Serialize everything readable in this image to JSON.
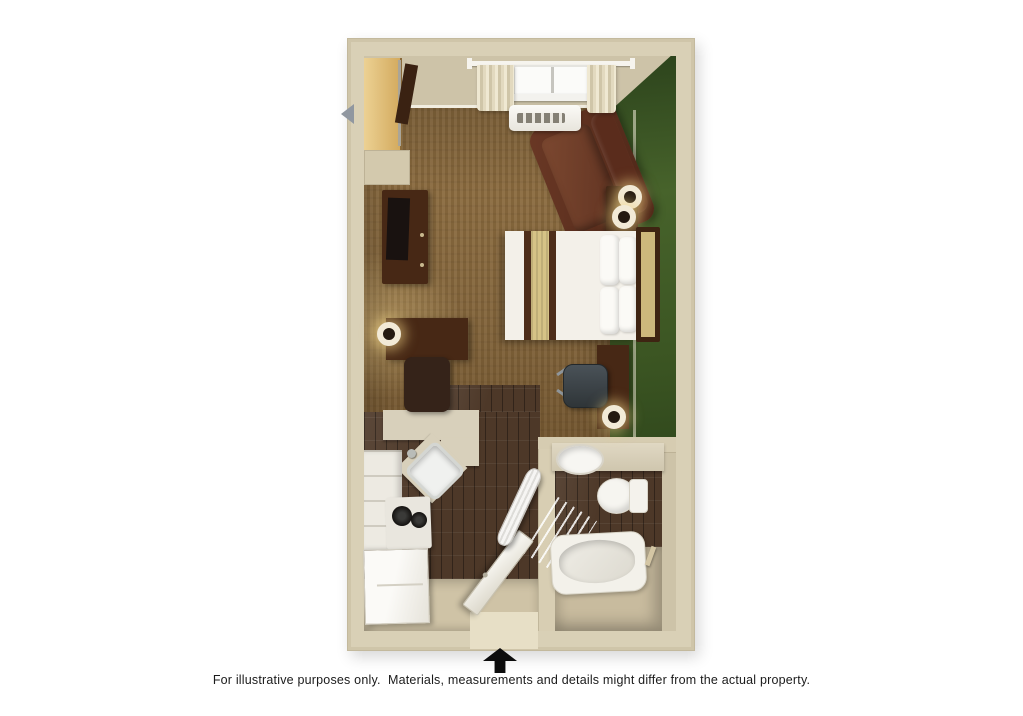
{
  "scene": {
    "type": "3d-floorplan-studio-suite",
    "caption": {
      "text": "For illustrative purposes only.  Materials, measurements and details might differ from the actual property."
    },
    "north_arrow": "entrance-direction-arrow"
  },
  "rooms": [
    {
      "name": "bedroom-living-area",
      "floor": "brown-carpet"
    },
    {
      "name": "kitchen",
      "floor": "dark-wood-plank"
    },
    {
      "name": "entry-hallway",
      "floor": "dark-wood-plank-and-tile"
    },
    {
      "name": "bathroom",
      "floor": "dark-wood-plank-and-tile"
    }
  ],
  "fixtures": [
    "wardrobe-closet",
    "closet-shelf",
    "closet-door",
    "tv-dresser",
    "television",
    "writing-desk",
    "desk-lamp",
    "desk-chair",
    "armchair-recliner",
    "nightstand",
    "table-lamp",
    "table-lamp",
    "queen-bed",
    "pillows",
    "headboard",
    "bedside-desk",
    "office-chair",
    "floor-lamp",
    "kitchen-counter",
    "corner-kitchen-sink",
    "faucet",
    "stove-cooktop",
    "kitchen-cabinets",
    "refrigerator",
    "entry-door",
    "ironing-board",
    "bathroom-vanity",
    "bathroom-sink",
    "toilet",
    "bathtub",
    "shower-curtain",
    "towel-bar",
    "window",
    "curtain-rod",
    "curtains",
    "ptac-ac-unit",
    "green-accent-wall"
  ],
  "palette": {
    "background": "#ffffff",
    "wall_tan": "#d9d0b6",
    "carpet_brown": "#8a6a3e",
    "wood_floor": "#4d3828",
    "accent_wall_green": "#3c5623",
    "furniture_dark_wood": "#472815",
    "bedding_white": "#f3f0e9",
    "bedding_band_tan": "#d6c386",
    "fixture_white": "#f3f1ea",
    "counter_tan": "#d8d0bb",
    "arrow_black": "#0d0d0d",
    "caption_text": "#1b1b1b"
  }
}
